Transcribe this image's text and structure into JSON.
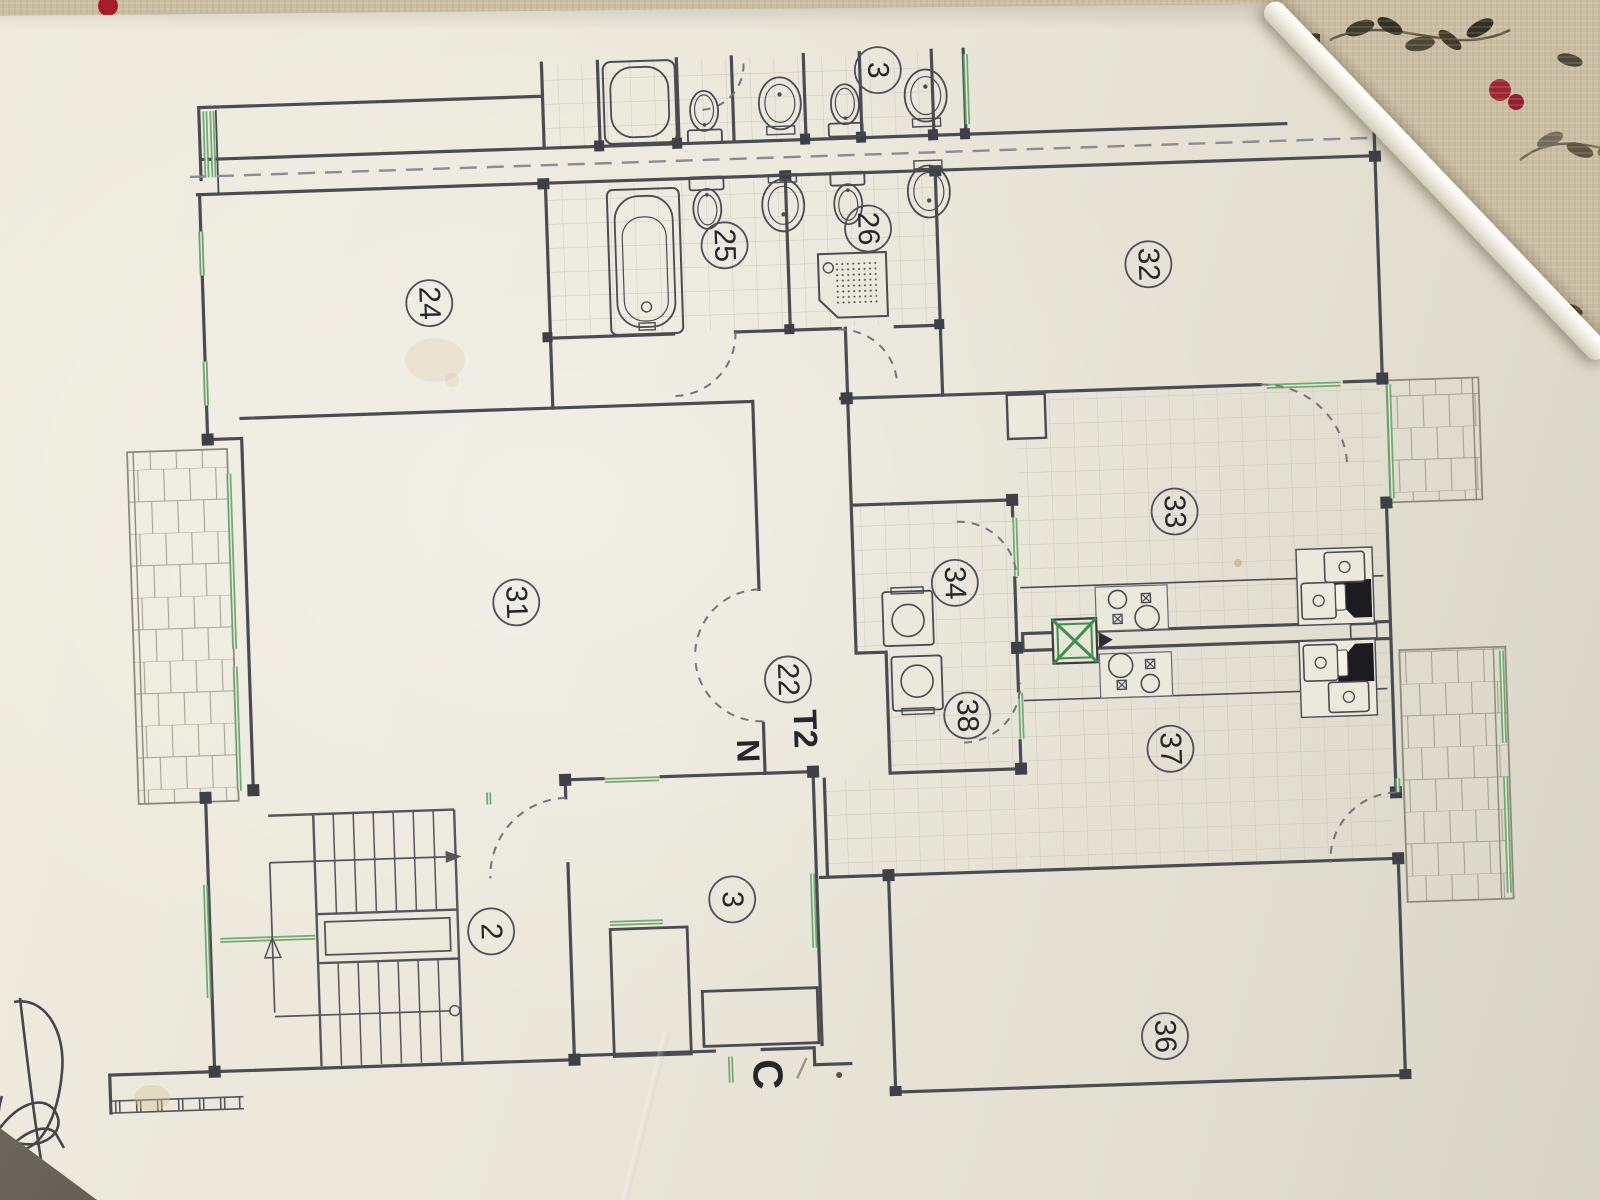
{
  "floorplan": {
    "unit_type_label": "T2",
    "north_label": "N",
    "entrance_label": "C",
    "room_numbers": {
      "bedroom_top_left": "24",
      "bathroom_main": "25",
      "bathroom_second": "26",
      "upper_unit_room": "3",
      "bedroom_top_right": "32",
      "living_room": "31",
      "kitchen_upper": "33",
      "laundry_upper": "34",
      "hallway": "22",
      "laundry_lower": "38",
      "kitchen_lower": "37",
      "stair_hall": "2",
      "entry_hall": "3",
      "room_bottom_right": "36"
    },
    "colors": {
      "wall": "#4b4b52",
      "window_green": "#63a368",
      "paper": "#eae7db",
      "fabric_base": "#c9bda2",
      "berry_red": "#a51c2c",
      "ink": "#2f2f36"
    }
  }
}
